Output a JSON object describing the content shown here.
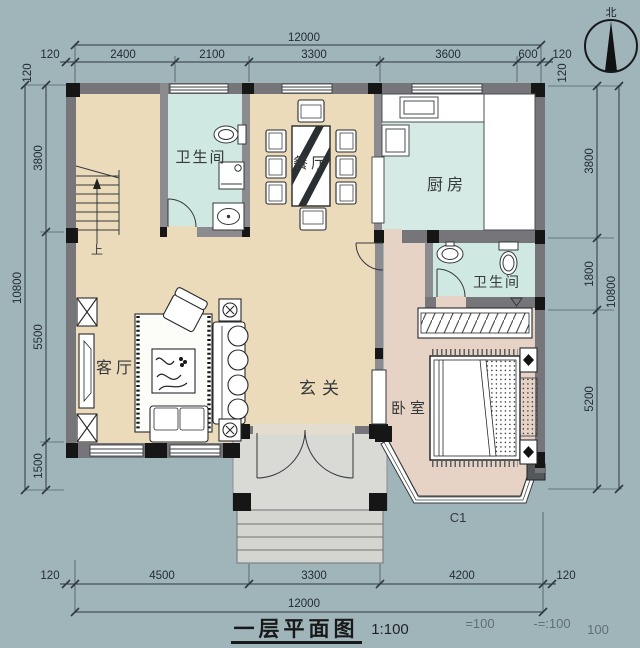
{
  "meta": {
    "width": 640,
    "height": 648,
    "drawing_type": "floor-plan"
  },
  "title_block": {
    "title": "一层平面图",
    "scale": "1:100",
    "ghost_1": "=100",
    "ghost_2": "-=:100",
    "ghost_3": "100"
  },
  "compass": {
    "north": "北"
  },
  "rooms": {
    "bathroom_top": "卫生间",
    "dining": "餐厅",
    "kitchen": "厨房",
    "bathroom_right": "卫生间",
    "living": "客厅",
    "hall": "玄关",
    "bedroom": "卧室",
    "stairs_up": "上",
    "window_code": "C1"
  },
  "dims": {
    "top": {
      "overall": "12000",
      "seg": [
        "120",
        "2400",
        "2100",
        "3300",
        "3600",
        "600",
        "120"
      ],
      "rot_left": "120",
      "rot_right": "120"
    },
    "left": {
      "overall": "10800",
      "seg": [
        "3800",
        "5500",
        "1500"
      ]
    },
    "right": {
      "overall": "10800",
      "seg": [
        "3800",
        "1800",
        "5200"
      ]
    },
    "bottom": {
      "overall": "12000",
      "seg": [
        "120",
        "4500",
        "3300",
        "4200",
        "120"
      ]
    }
  },
  "colors": {
    "background": "#a0b5ba",
    "floor_main": "#ecdbba",
    "floor_wet": "#cfe8e2",
    "floor_bedroom": "#e7d2c6",
    "floor_porch": "#d9d9d6",
    "wall_fill": "#76767a",
    "column_fill": "#161616",
    "line": "#2d383c"
  }
}
